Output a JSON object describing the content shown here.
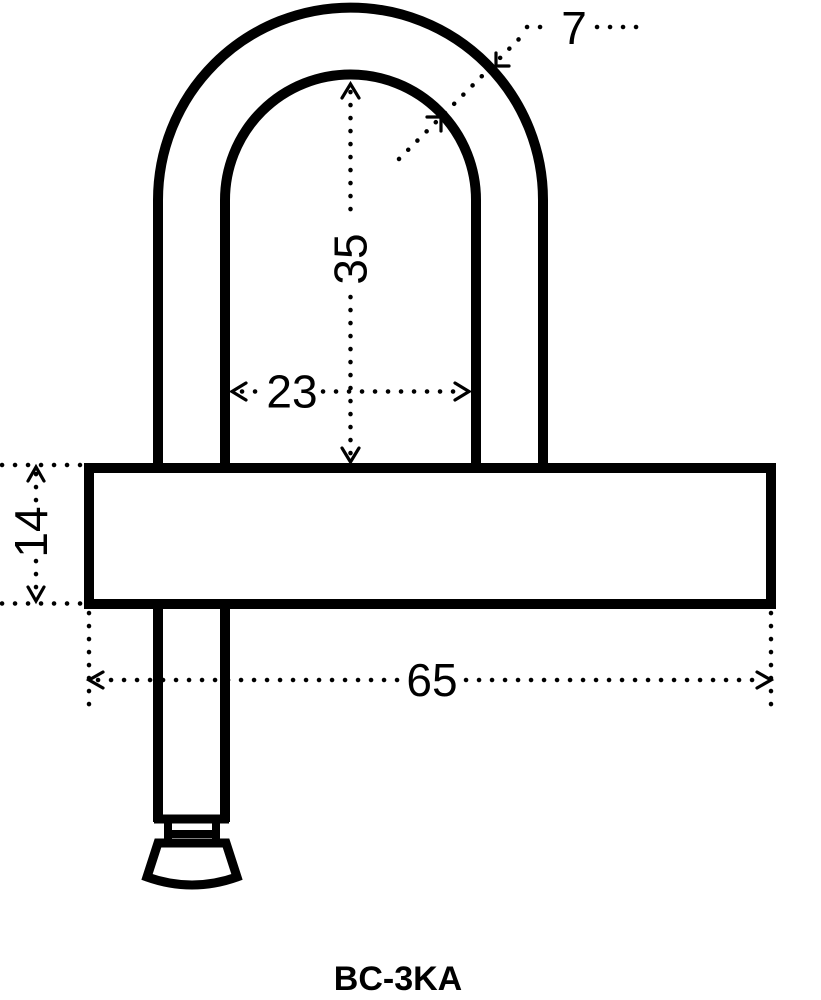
{
  "drawing": {
    "title": "BC-3KA",
    "type_note": "padlock technical dimension drawing",
    "dimensions": {
      "shackle_thickness": "7",
      "shackle_inner_height": "35",
      "shackle_inner_width": "23",
      "body_height": "14",
      "body_width": "65"
    },
    "colors": {
      "line": "#000000",
      "background": "#ffffff"
    }
  }
}
